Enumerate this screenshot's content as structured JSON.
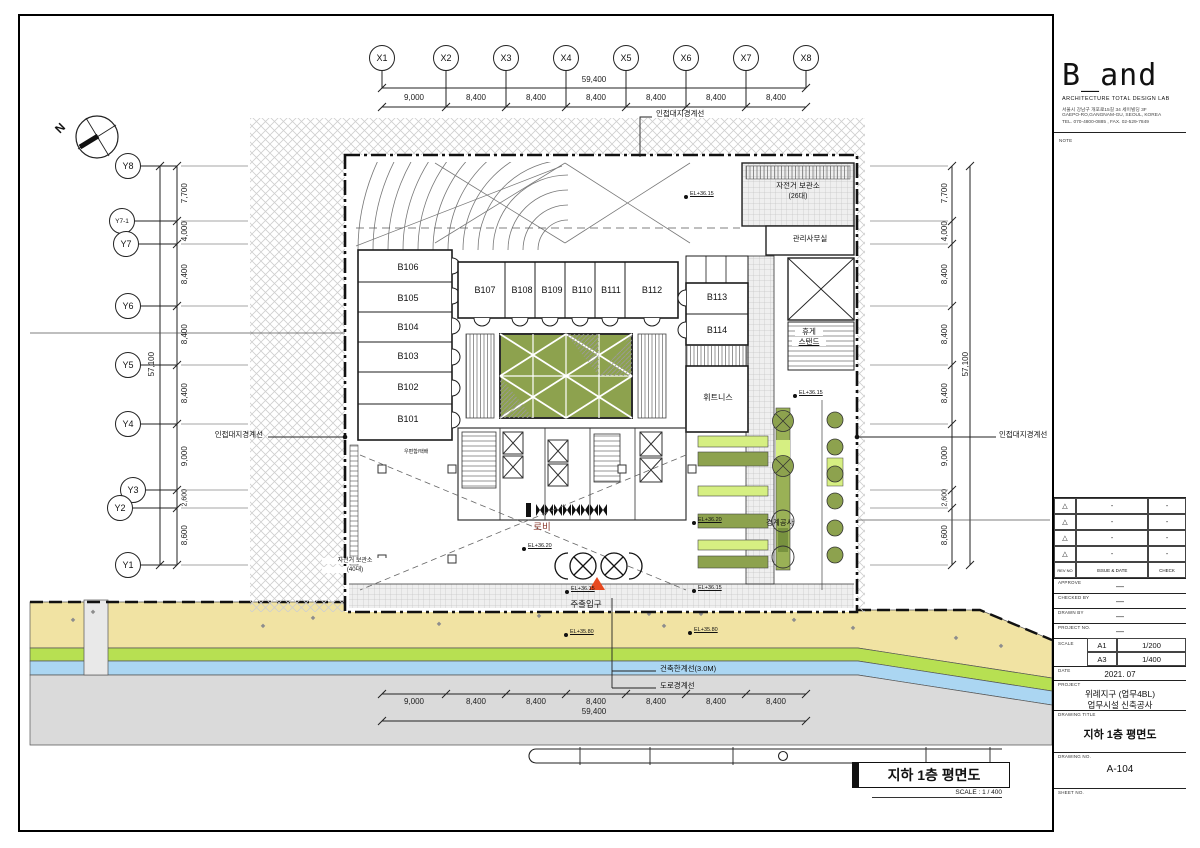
{
  "sheet": {
    "north_label": "N"
  },
  "grid": {
    "x_bubbles": [
      "X1",
      "X2",
      "X3",
      "X4",
      "X5",
      "X6",
      "X7",
      "X8"
    ],
    "y_bubbles": [
      "Y8",
      "Y7-1",
      "Y7",
      "Y6",
      "Y5",
      "Y4",
      "Y3",
      "Y2",
      "Y1"
    ],
    "top_segments": [
      "9,000",
      "8,400",
      "8,400",
      "8,400",
      "8,400",
      "8,400",
      "8,400"
    ],
    "top_total": "59,400",
    "bottom_segments": [
      "9,000",
      "8,400",
      "8,400",
      "8,400",
      "8,400",
      "8,400",
      "8,400"
    ],
    "bottom_total": "59,400",
    "left_segments": [
      "7,700",
      "4,000",
      "8,400",
      "8,400",
      "8,400",
      "9,000",
      "2,600",
      "8,600"
    ],
    "left_total": "57,100",
    "right_segments": [
      "7,700",
      "4,000",
      "8,400",
      "8,400",
      "8,400",
      "9,000",
      "2,600",
      "8,600"
    ],
    "right_total": "57,100"
  },
  "plan": {
    "rooms": {
      "left": [
        "B106",
        "B105",
        "B104",
        "B103",
        "B102",
        "B101"
      ],
      "top": [
        "B107",
        "B108",
        "B109",
        "B110",
        "B111",
        "B112"
      ],
      "right": [
        "B113",
        "B114"
      ]
    },
    "labels": {
      "site_boundary": "인접대지경계선",
      "bike_top": "자전거 보관소",
      "bike_top_count": "(26대)",
      "office": "관리사무실",
      "rest_line1": "휴게",
      "rest_line2": "스탠드",
      "fitness": "휘트니스",
      "lobby": "로비",
      "main_entrance": "주출입구",
      "bike_left_line1": "자전거 보관소",
      "bike_left_line2": "(40대)",
      "mailbox": "우편함/택배",
      "boundary_work": "경계공사",
      "building_limit": "건축한계선(3.0M)",
      "road_boundary": "도로경계선"
    },
    "levels": {
      "el_36_15": "EL+36.15",
      "el_36_20": "EL+36.20",
      "el_35_80": "EL+35.80"
    }
  },
  "footer": {
    "title": "지하 1층 평면도",
    "scale": "SCALE : 1 / 400"
  },
  "titleblock": {
    "logo": "B_and",
    "firm": "ARCHITECTURE TOTAL DESIGN LAB",
    "addr1": "서울시 강남구 개포로15길 34 세이빌딩 3F",
    "addr2": "GAEPO-RO,GANGNAM-GU, SEOUL, KOREA",
    "addr3": "TEL. 070-4800-0885 , FAX. 02-529-7849",
    "note": "NOTE",
    "rev_rows": [
      {
        "mark": "△",
        "issue": "-",
        "check": "-"
      },
      {
        "mark": "△",
        "issue": "-",
        "check": "-"
      },
      {
        "mark": "△",
        "issue": "-",
        "check": "-"
      },
      {
        "mark": "△",
        "issue": "-",
        "check": "-"
      }
    ],
    "rev_no": "REV NO",
    "issue_date": "ISSUE & DATE",
    "check": "CHECK",
    "approve_label": "APPROVE",
    "approve_value": "—",
    "checked_label": "CHECKED BY",
    "checked_value": "—",
    "drawn_label": "DRAWN BY",
    "drawn_value": "—",
    "project_no_label": "PROJECT NO.",
    "project_no_value": "—",
    "scale_label": "SCALE",
    "scale_a1_label": "A1",
    "scale_a1_value": "1/200",
    "scale_a3_label": "A3",
    "scale_a3_value": "1/400",
    "date_label": "DATE",
    "date_value": "2021. 07",
    "project_label": "PROJECT",
    "project_line1": "위례지구 (업무4BL)",
    "project_line2": "업무시설 신축공사",
    "drawing_title_label": "DRAWING TITLE",
    "drawing_title": "지하 1층 평면도",
    "drawing_no_label": "DRAWING NO.",
    "drawing_no": "A-104",
    "sheet_no_label": "SHEET NO."
  }
}
